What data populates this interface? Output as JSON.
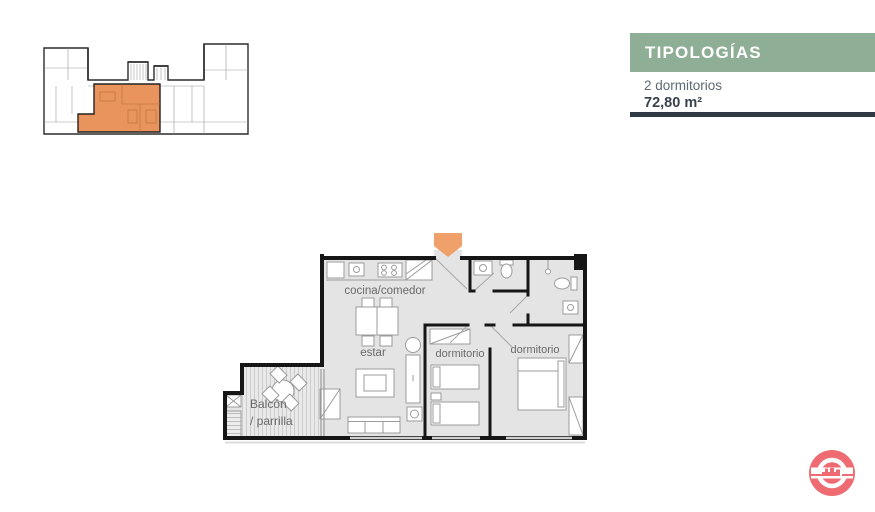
{
  "header": {
    "title": "TIPOLOGÍAS",
    "subtitle": "2 dormitorios",
    "area": "72,80 m²",
    "accent_color": "#8fae96",
    "rule_color": "#2e3943",
    "title_color": "#ffffff",
    "subtitle_color": "#5f6a73",
    "area_color": "#39424c"
  },
  "key_plan": {
    "description": "building floor key plan with highlighted unit",
    "highlight_color": "#e8945c"
  },
  "floor_plan": {
    "labels": {
      "kitchen": "cocina/comedor",
      "living": "estar",
      "bedroom_1": "dormitorio",
      "bedroom_2": "dormitorio",
      "balcony_1": "Balcón",
      "balcony_2": "/ parrilla"
    },
    "colors": {
      "floor": "#e4e4e4",
      "wall": "#161616",
      "furniture_stroke": "#9b9b9b",
      "label": "#6a6a6a",
      "entrance_arrow": "#f0a06a"
    }
  },
  "logo": {
    "color": "#ee6c71"
  }
}
